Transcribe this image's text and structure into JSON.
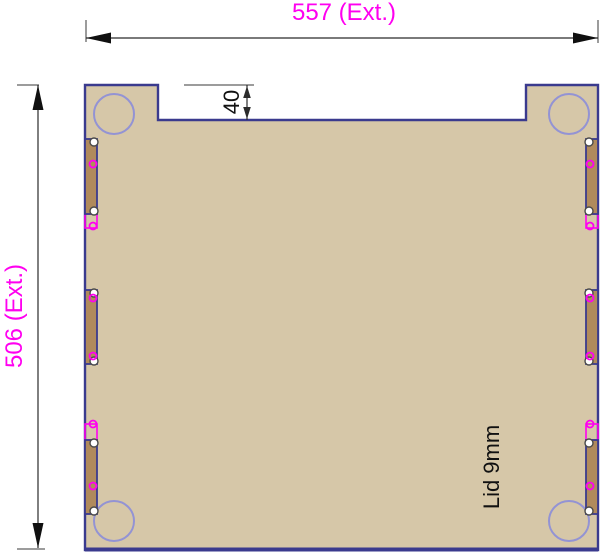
{
  "drawing": {
    "part_name": "Lid",
    "material_thickness": "9mm",
    "part_label": "Lid 9mm",
    "width_dimension_label": "557 (Ext.)",
    "height_dimension_label": "506 (Ext.)",
    "notch_dimension_label": "40",
    "width_value": 557,
    "height_value": 506,
    "notch_depth_value": 40
  },
  "colors": {
    "background": "#ffffff",
    "panel-fill": "#d6c7a8",
    "slot-fill": "#b08a5c",
    "outline": "#3a3a8e",
    "corner-circle": "#9393d4",
    "magenta": "#ff00f0",
    "dimension-text": "#ff00f0",
    "line": "#2b2b2b"
  }
}
